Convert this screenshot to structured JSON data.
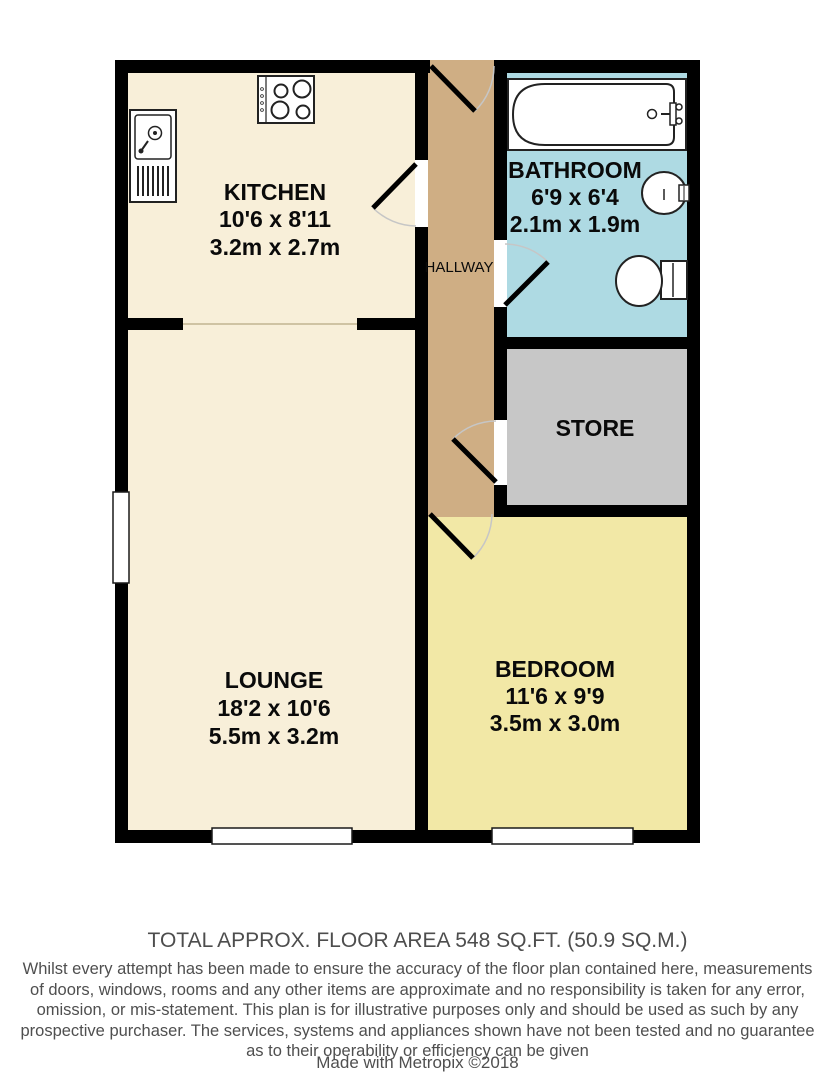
{
  "plan": {
    "rooms": {
      "kitchen": {
        "label": "KITCHEN",
        "dims_ft": "10'6 x 8'11",
        "dims_m": "3.2m x 2.7m"
      },
      "bathroom": {
        "label": "BATHROOM",
        "dims_ft": "6'9 x 6'4",
        "dims_m": "2.1m x 1.9m"
      },
      "hallway": {
        "label": "HALLWAY"
      },
      "store": {
        "label": "STORE"
      },
      "lounge": {
        "label": "LOUNGE",
        "dims_ft": "18'2 x 10'6",
        "dims_m": "5.5m x 3.2m"
      },
      "bedroom": {
        "label": "BEDROOM",
        "dims_ft": "11'6 x 9'9",
        "dims_m": "3.5m x 3.0m"
      }
    },
    "colors": {
      "kitchen_lounge_floor": "#f8efd9",
      "hallway_floor": "#cfae84",
      "bathroom_floor": "#aedae3",
      "store_floor": "#c7c7c7",
      "bedroom_floor": "#f2e8a6",
      "walls": "#000000",
      "label_text": "#0a0a0a",
      "footer_text": "#4f4f4f"
    }
  },
  "footer": {
    "total_area": "TOTAL APPROX. FLOOR AREA 548 SQ.FT. (50.9 SQ.M.)",
    "disclaimer_lines": [
      "Whilst every attempt has been made to ensure the accuracy of the floor plan contained here, measurements",
      "of doors, windows, rooms and any other items are approximate and no responsibility is taken for any error,",
      "omission, or mis-statement. This plan is for illustrative purposes only and should be used as such by any",
      "prospective purchaser. The services, systems and appliances shown have not been tested and no guarantee",
      "as to their operability or efficiency can be given"
    ],
    "credit": "Made with Metropix ©2018"
  }
}
